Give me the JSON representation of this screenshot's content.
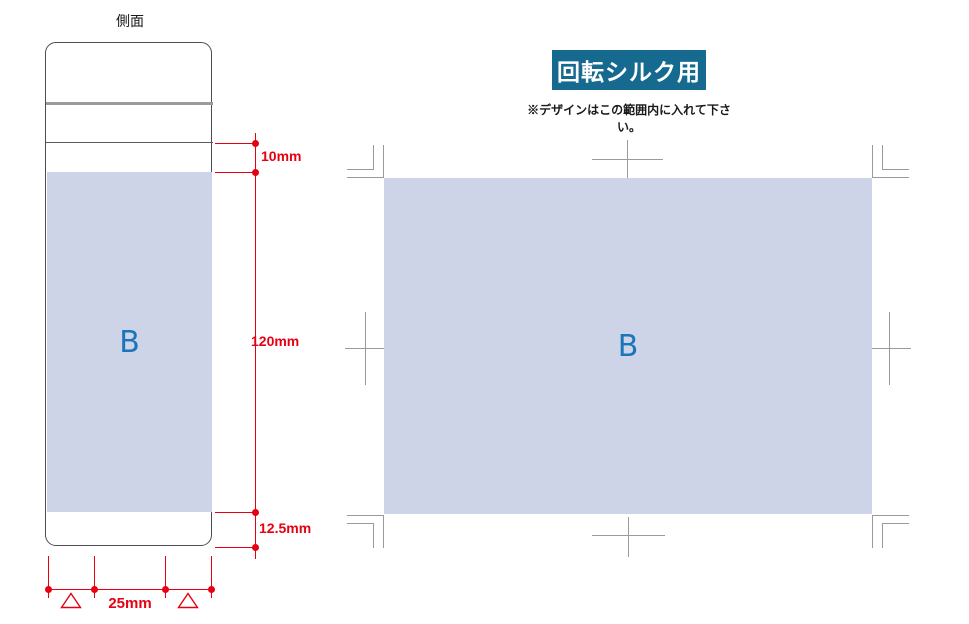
{
  "side_view": {
    "label": "側面",
    "print_area_label": "B",
    "dim_top": "10mm",
    "dim_height": "120mm",
    "dim_bottom": "12.5mm",
    "dim_width": "25mm"
  },
  "design_area": {
    "title": "回転シルク用",
    "note": "※デザインはこの範囲内に入れて下さい。",
    "print_area_label": "B"
  },
  "colors": {
    "dimension_red": "#e60012",
    "title_background": "#16698f",
    "title_text": "#ffffff",
    "print_area_fill": "#cdd4e7",
    "marker_blue": "#1b75bb",
    "trim_mark_gray": "#9a9a9a",
    "outline_dark": "#4d4d4d"
  }
}
